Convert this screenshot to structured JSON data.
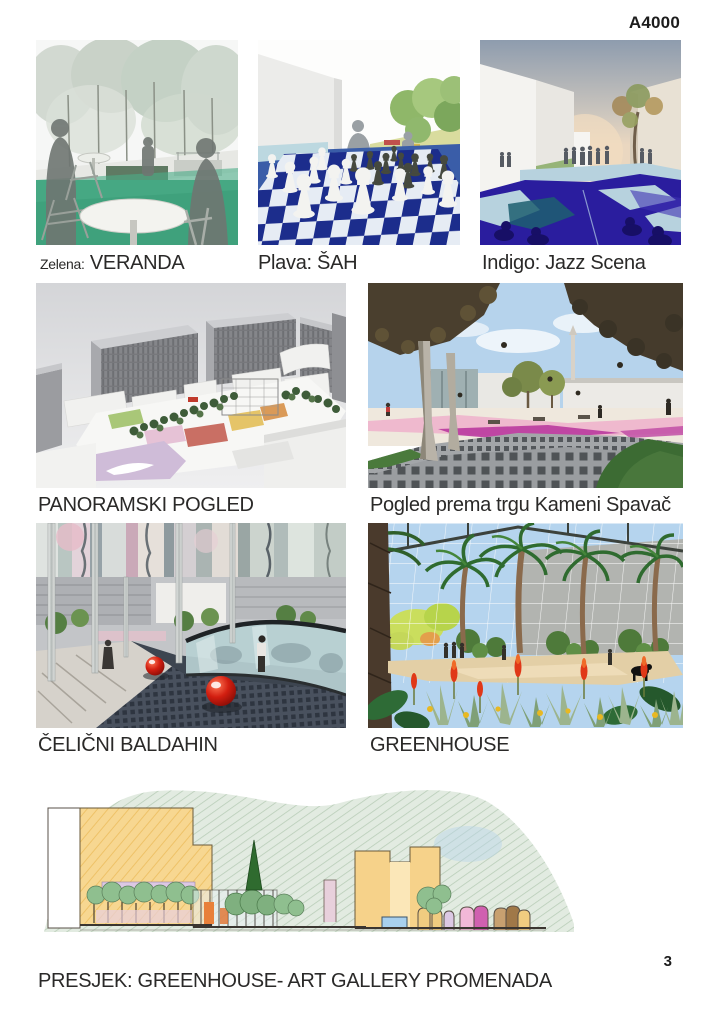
{
  "page": {
    "code": "A4000",
    "number": "3"
  },
  "palette": {
    "zelena": "#3fa17c",
    "plava": "#3a5da8",
    "indigo": "#2a1d9e"
  },
  "figures": {
    "veranda": {
      "caption_prefix": "Zelena:",
      "caption": "VERANDA"
    },
    "sah": {
      "caption": "Plava: ŠAH"
    },
    "jazz": {
      "caption": "Indigo: Jazz Scena"
    },
    "panorama": {
      "caption": "PANORAMSKI POGLED"
    },
    "trg": {
      "caption": "Pogled prema trgu Kameni Spavač"
    },
    "baldahin": {
      "caption": "ČELIČNI BALDAHIN"
    },
    "greenhouse": {
      "caption": "GREENHOUSE"
    },
    "presjek": {
      "caption": "PRESJEK: GREENHOUSE- ART GALLERY PROMENADA"
    }
  }
}
